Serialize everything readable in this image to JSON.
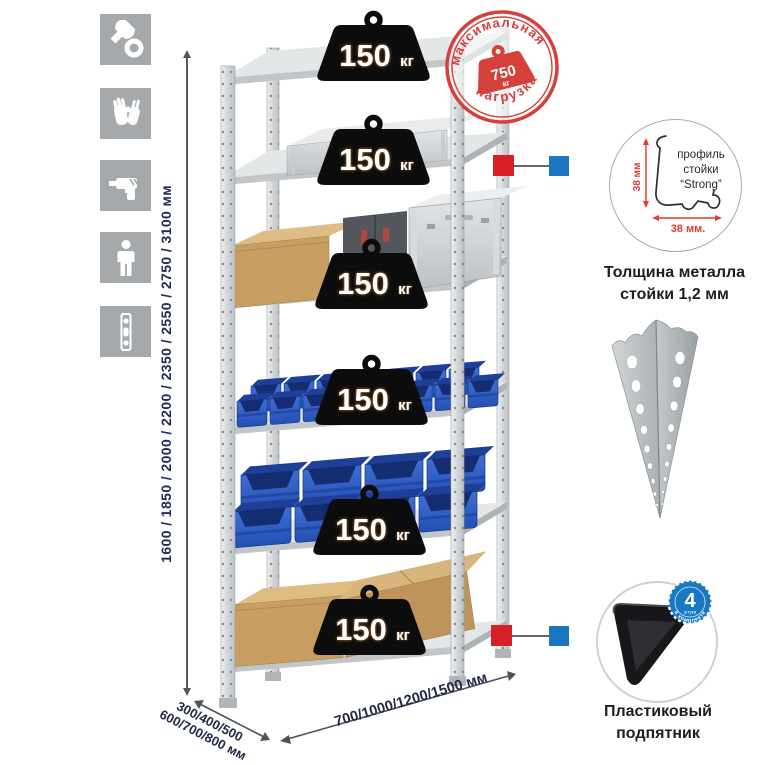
{
  "title": "Metal shelving rack infographic",
  "colors": {
    "icon_gray": "#a6a9ab",
    "metal": "#d7dadb",
    "bin_blue": "#2d5ec6",
    "badge_black": "#0c0c0d",
    "stamp_red": "#d5403b",
    "connector_red": "#d81f26",
    "connector_blue": "#1b75c0",
    "count_badge_blue": "#1878c2",
    "dimension_text": "#242a57"
  },
  "assembly_icons": [
    {
      "name": "wrench-icon"
    },
    {
      "name": "gloves-icon"
    },
    {
      "name": "drill-icon"
    },
    {
      "name": "person-icon"
    },
    {
      "name": "post-strip-icon"
    }
  ],
  "height_dimension": {
    "label": "1600 / 1850 / 2000 / 2200 / 2350 / 2550 / 2750 / 3100 мм"
  },
  "depth_dimension": {
    "line1": "300/400/500",
    "line2": "600/700/800 мм"
  },
  "width_dimension": {
    "label": "700/1000/1200/1500 мм"
  },
  "max_load_stamp": {
    "arc_top": "максимальная",
    "arc_bottom": "нагрузка",
    "value": "750",
    "unit": "кг"
  },
  "rack": {
    "shelf_count": 6
  },
  "shelf_badges": [
    {
      "value": "150",
      "unit": "кг"
    },
    {
      "value": "150",
      "unit": "кг"
    },
    {
      "value": "150",
      "unit": "кг"
    },
    {
      "value": "150",
      "unit": "кг"
    },
    {
      "value": "150",
      "unit": "кг"
    },
    {
      "value": "150",
      "unit": "кг"
    }
  ],
  "profile_callout": {
    "dim_vertical": "38 мм",
    "dim_horizontal": "38 мм.",
    "label_line1": "профиль",
    "label_line2": "стойки",
    "label_line3": "“Strong”",
    "caption_line1": "Толщина металла",
    "caption_line2": "стойки 1,2 мм"
  },
  "foot_callout": {
    "badge_value": "4",
    "badge_small": "штуки",
    "badge_ring": "в комплекте",
    "caption_line1": "Пластиковый",
    "caption_line2": "подпятник"
  }
}
